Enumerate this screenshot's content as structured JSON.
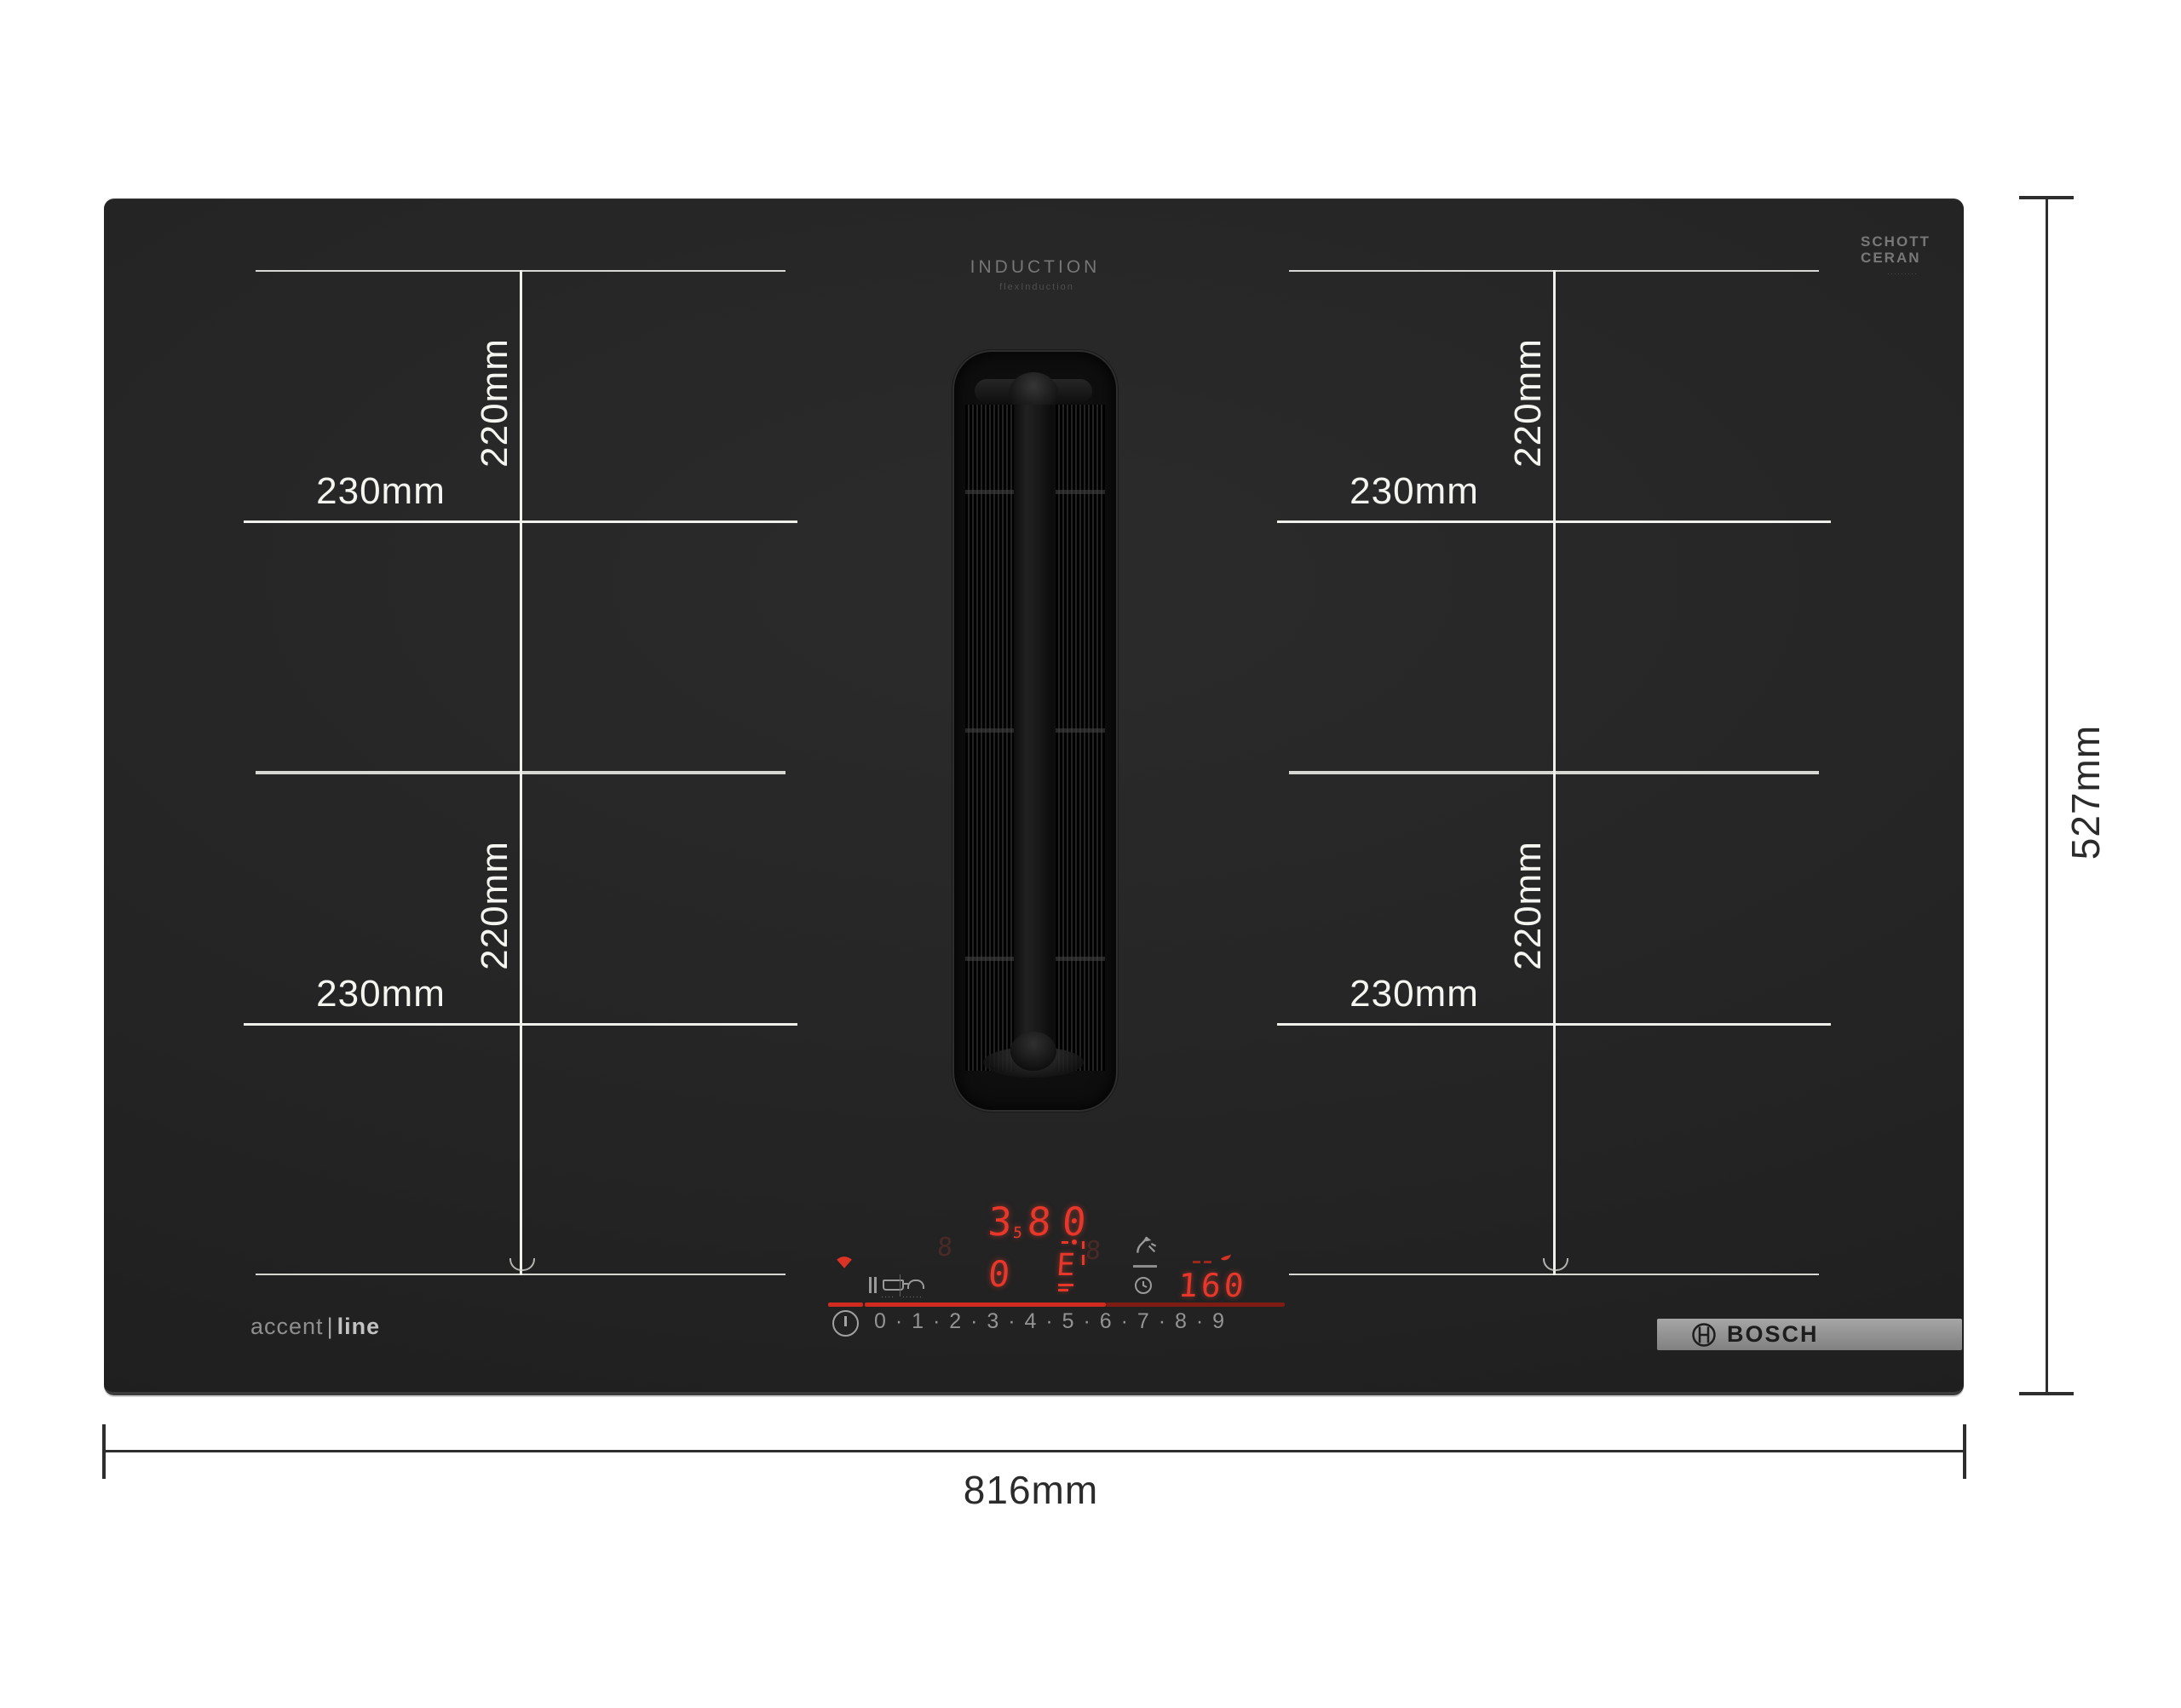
{
  "hob": {
    "induction_label": "INDUCTION",
    "induction_sub": "flexInduction",
    "glass_brand": {
      "line1": "SCHOTT",
      "line2": "CERAN",
      "sub": "·········"
    },
    "series": {
      "left": "accent",
      "divider": "|",
      "right": "line"
    },
    "bosch_text": "BOSCH"
  },
  "zones": [
    {
      "id": "top-left",
      "width_label": "230mm",
      "height_label": "220mm"
    },
    {
      "id": "bottom-left",
      "width_label": "230mm",
      "height_label": "220mm"
    },
    {
      "id": "top-right",
      "width_label": "230mm",
      "height_label": "220mm"
    },
    {
      "id": "bottom-right",
      "width_label": "230mm",
      "height_label": "220mm"
    }
  ],
  "dimensions": {
    "width": "816mm",
    "height": "527mm"
  },
  "control_panel": {
    "display": {
      "level_main": "3",
      "level_half": "5",
      "level_2": "8",
      "level_3": "0",
      "level_bottom": "0",
      "filter_glyph": "E",
      "ghost": "8"
    },
    "timer": "160",
    "scale": "0 · 1 · 2 · 3 · 4 · 5 · 6 · 7 · 8 · 9",
    "icon_sub_1": "····",
    "icon_sub_2": "······"
  }
}
